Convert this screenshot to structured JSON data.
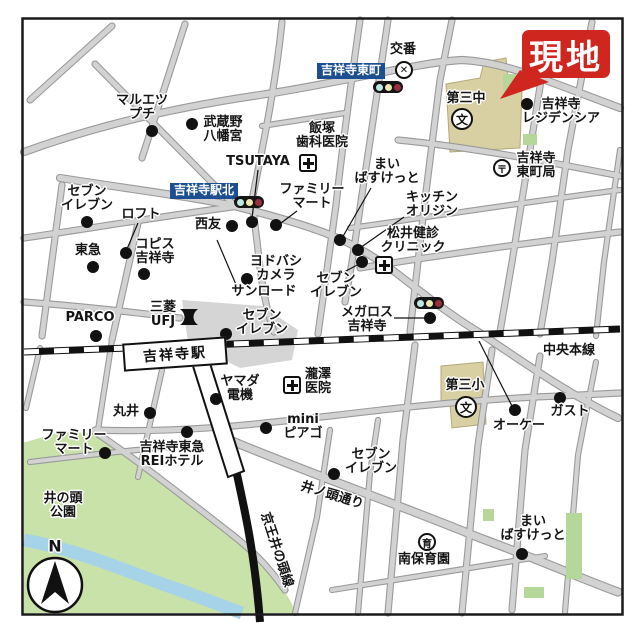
{
  "map": {
    "genchi": {
      "text": "現地",
      "x": 522,
      "y": 30,
      "w": 88,
      "h": 48
    },
    "station": {
      "label": "吉祥寺駅",
      "x": 123,
      "y": 340,
      "w": 100,
      "h": 24,
      "rotate": -4
    },
    "compass": {
      "label": "N"
    },
    "colors": {
      "accent_red": "#cf261f",
      "sign_blue": "#1c4e91",
      "park_green": "#c9e2a9",
      "river_blue": "#a6d3e8",
      "school_tan": "#d8cfa2",
      "road_fill": "#d2d2d2",
      "road_edge": "#9a9a9a"
    },
    "signs": [
      {
        "id": "sign-higashicho",
        "text": "吉祥寺東町",
        "x": 317,
        "y": 63
      },
      {
        "id": "sign-ekikita",
        "text": "吉祥寺駅北",
        "x": 170,
        "y": 183
      }
    ],
    "labels": [
      {
        "id": "kouban",
        "lines": [
          "交番"
        ],
        "x": 403,
        "y": 50
      },
      {
        "id": "residencia",
        "lines": [
          "吉祥寺",
          "レジデンシア"
        ],
        "x": 561,
        "y": 112
      },
      {
        "id": "daisanchu",
        "lines": [
          "第三中"
        ],
        "x": 466,
        "y": 99
      },
      {
        "id": "po-higashicho",
        "lines": [
          "吉祥寺",
          "東町局"
        ],
        "x": 536,
        "y": 166
      },
      {
        "id": "maruetsu-petit",
        "lines": [
          "マルエツ",
          "プチ"
        ],
        "x": 142,
        "y": 108
      },
      {
        "id": "hachimangu",
        "lines": [
          "武蔵野",
          "八幡宮"
        ],
        "x": 223,
        "y": 130
      },
      {
        "id": "tsutaya",
        "lines": [
          "TSUTAYA"
        ],
        "x": 258,
        "y": 162
      },
      {
        "id": "iizuka-dental",
        "lines": [
          "飯塚",
          "歯科医院"
        ],
        "x": 322,
        "y": 136
      },
      {
        "id": "famima-kita",
        "lines": [
          "ファミリー",
          "マート"
        ],
        "x": 312,
        "y": 197
      },
      {
        "id": "maibasket-n",
        "lines": [
          "まい",
          "ばすけっと"
        ],
        "x": 387,
        "y": 172
      },
      {
        "id": "kitchen-origin",
        "lines": [
          "キッチン",
          "オリジン"
        ],
        "x": 432,
        "y": 205
      },
      {
        "id": "matsui-clinic",
        "lines": [
          "松井健診",
          "クリニック"
        ],
        "x": 413,
        "y": 241
      },
      {
        "id": "seven-nw",
        "lines": [
          "セブン",
          "イレブン"
        ],
        "x": 87,
        "y": 199
      },
      {
        "id": "loft",
        "lines": [
          "ロフト"
        ],
        "x": 141,
        "y": 215
      },
      {
        "id": "copis",
        "lines": [
          "コピス",
          "吉祥寺"
        ],
        "x": 155,
        "y": 252
      },
      {
        "id": "tokyu",
        "lines": [
          "東急"
        ],
        "x": 88,
        "y": 251
      },
      {
        "id": "seiyu",
        "lines": [
          "西友"
        ],
        "x": 208,
        "y": 225
      },
      {
        "id": "yodobashi",
        "lines": [
          "ヨドバシ",
          "カメラ"
        ],
        "x": 276,
        "y": 269
      },
      {
        "id": "sunroad",
        "lines": [
          "サンロード"
        ],
        "x": 264,
        "y": 292
      },
      {
        "id": "seven-center",
        "lines": [
          "セブン",
          "イレブン"
        ],
        "x": 262,
        "y": 323
      },
      {
        "id": "mitsubishi-ufj",
        "lines": [
          "三菱",
          "UFJ"
        ],
        "x": 163,
        "y": 315
      },
      {
        "id": "parco",
        "lines": [
          "PARCO"
        ],
        "x": 90,
        "y": 318
      },
      {
        "id": "megalos",
        "lines": [
          "メガロス",
          "吉祥寺"
        ],
        "x": 367,
        "y": 320
      },
      {
        "id": "seven-mid",
        "lines": [
          "セブン",
          "イレブン"
        ],
        "x": 336,
        "y": 286
      },
      {
        "id": "chuo-line",
        "lines": [
          "中央本線"
        ],
        "x": 569,
        "y": 351
      },
      {
        "id": "yamada-denki",
        "lines": [
          "ヤマダ",
          "電機"
        ],
        "x": 240,
        "y": 389
      },
      {
        "id": "takizawa-clinic",
        "lines": [
          "瀧澤",
          "医院"
        ],
        "x": 318,
        "y": 382
      },
      {
        "id": "daisansho",
        "lines": [
          "第三小"
        ],
        "x": 465,
        "y": 386
      },
      {
        "id": "ok-store",
        "lines": [
          "オーケー"
        ],
        "x": 519,
        "y": 426
      },
      {
        "id": "gusto",
        "lines": [
          "ガスト"
        ],
        "x": 570,
        "y": 412
      },
      {
        "id": "marui",
        "lines": [
          "丸井"
        ],
        "x": 126,
        "y": 412
      },
      {
        "id": "mini-piago",
        "lines": [
          "mini",
          "ピアゴ"
        ],
        "x": 303,
        "y": 427
      },
      {
        "id": "famima-s",
        "lines": [
          "ファミリー",
          "マート"
        ],
        "x": 74,
        "y": 443
      },
      {
        "id": "rei-hotel",
        "lines": [
          "吉祥寺東急",
          "REIホテル"
        ],
        "x": 172,
        "y": 455
      },
      {
        "id": "inokashira-park",
        "lines": [
          "井の頭",
          "公園"
        ],
        "x": 63,
        "y": 506
      },
      {
        "id": "seven-s",
        "lines": [
          "セブン",
          "イレブン"
        ],
        "x": 371,
        "y": 462
      },
      {
        "id": "inokashira-dori",
        "lines": [
          "井ノ頭通り"
        ],
        "x": 332,
        "y": 496,
        "rotate": 17
      },
      {
        "id": "keio-line",
        "lines": [
          "京王井の頭線"
        ],
        "x": 276,
        "y": 550,
        "rotate": 72
      },
      {
        "id": "minami-hoikuen",
        "lines": [
          "南保育園"
        ],
        "x": 424,
        "y": 560
      },
      {
        "id": "maibasket-s",
        "lines": [
          "まい",
          "ばすけっと"
        ],
        "x": 533,
        "y": 529
      },
      {
        "id": "compass-n",
        "lines": [
          "N"
        ],
        "x": 55,
        "y": 546,
        "size": 16
      }
    ],
    "dots": [
      {
        "id": "residencia",
        "x": 527,
        "y": 104
      },
      {
        "id": "maruetsu",
        "x": 152,
        "y": 131
      },
      {
        "id": "hachimangu",
        "x": 192,
        "y": 124
      },
      {
        "id": "seven-nw",
        "x": 87,
        "y": 222
      },
      {
        "id": "loft",
        "x": 126,
        "y": 253
      },
      {
        "id": "copis",
        "x": 144,
        "y": 274
      },
      {
        "id": "tokyu",
        "x": 93,
        "y": 267
      },
      {
        "id": "seiyu",
        "x": 232,
        "y": 226
      },
      {
        "id": "tsutaya",
        "x": 252,
        "y": 222
      },
      {
        "id": "famima-kita",
        "x": 276,
        "y": 225
      },
      {
        "id": "maibasket-n",
        "x": 340,
        "y": 240
      },
      {
        "id": "kitchen-origin",
        "x": 358,
        "y": 250
      },
      {
        "id": "seven-mid",
        "x": 362,
        "y": 262
      },
      {
        "id": "yodobashi",
        "x": 247,
        "y": 279
      },
      {
        "id": "seven-center",
        "x": 226,
        "y": 334
      },
      {
        "id": "parco",
        "x": 96,
        "y": 336
      },
      {
        "id": "megalos",
        "x": 430,
        "y": 318
      },
      {
        "id": "yamada",
        "x": 216,
        "y": 399
      },
      {
        "id": "marui",
        "x": 150,
        "y": 413
      },
      {
        "id": "ok-store",
        "x": 515,
        "y": 410
      },
      {
        "id": "gusto",
        "x": 560,
        "y": 398
      },
      {
        "id": "mini-piago",
        "x": 266,
        "y": 428
      },
      {
        "id": "famima-s",
        "x": 105,
        "y": 453
      },
      {
        "id": "rei-hotel",
        "x": 187,
        "y": 432
      },
      {
        "id": "seven-s",
        "x": 334,
        "y": 474
      },
      {
        "id": "maibasket-s",
        "x": 522,
        "y": 554
      }
    ],
    "leaders": [
      [
        258,
        170,
        252,
        218
      ],
      [
        297,
        211,
        277,
        226
      ],
      [
        371,
        188,
        342,
        238
      ],
      [
        404,
        217,
        360,
        248
      ],
      [
        138,
        223,
        127,
        249
      ],
      [
        217,
        240,
        237,
        287
      ],
      [
        394,
        318,
        426,
        318
      ],
      [
        479,
        341,
        512,
        406
      ],
      [
        344,
        272,
        361,
        263
      ]
    ],
    "symbols": [
      {
        "id": "kouban-x-icon",
        "type": "kouban",
        "x": 404,
        "y": 70,
        "glyph": "✕"
      },
      {
        "id": "traffic-light-higashicho-icon",
        "type": "traffic",
        "x": 388,
        "y": 87
      },
      {
        "id": "traffic-light-ekikita-icon",
        "type": "traffic",
        "x": 249,
        "y": 202
      },
      {
        "id": "traffic-light-megalos-icon",
        "type": "traffic",
        "x": 429,
        "y": 303
      },
      {
        "id": "post-office-icon",
        "type": "post",
        "x": 502,
        "y": 168,
        "glyph": "〒"
      },
      {
        "id": "hospital-iizuka-icon",
        "type": "hospital",
        "x": 308,
        "y": 163
      },
      {
        "id": "hospital-matsui-icon",
        "type": "hospital",
        "x": 384,
        "y": 265
      },
      {
        "id": "hospital-takizawa-icon",
        "type": "hospital",
        "x": 292,
        "y": 385
      },
      {
        "id": "school-daisanchu-icon",
        "type": "school",
        "x": 462,
        "y": 119,
        "glyph": "文"
      },
      {
        "id": "school-daisansho-icon",
        "type": "school",
        "x": 466,
        "y": 407,
        "glyph": "文"
      },
      {
        "id": "nursery-minami-icon",
        "type": "nursery",
        "x": 427,
        "y": 542,
        "glyph": "育"
      },
      {
        "id": "bank-ufj-icon",
        "type": "bank",
        "x": 189,
        "y": 317
      }
    ],
    "traffic_colors": [
      "#bfe8e2",
      "#efe8b0",
      "#9c2f3d"
    ]
  }
}
